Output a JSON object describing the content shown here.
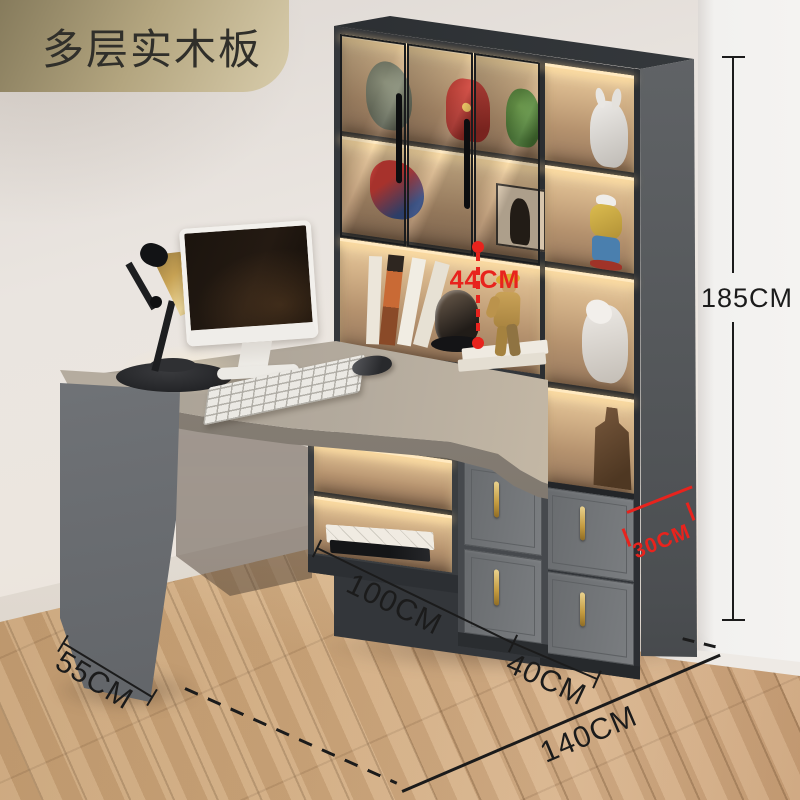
{
  "badge": {
    "label": "多层实木板"
  },
  "dimensions": {
    "shelf_clearance": {
      "label": "44CM"
    },
    "total_height": {
      "label": "185CM"
    },
    "cabinet_side_depth": {
      "label": "30CM"
    },
    "desk_length": {
      "label": "100CM"
    },
    "cabinet_front_width": {
      "label": "40CM"
    },
    "total_width": {
      "label": "140CM"
    },
    "desk_depth": {
      "label": "55CM"
    }
  },
  "palette": {
    "annotation_red": "#e8231d",
    "annotation_black": "#1b1b1b",
    "badge_gold_dark": "#8f8466",
    "badge_gold_light": "#d8ccab",
    "cabinet_charcoal": "#3f4246",
    "shelf_interior_tan": "#c8a27c",
    "led_glow": "#ffe9c0",
    "desk_gray": "#b3aa9d",
    "floor_wood": "#cda77c",
    "wall_beige": "#eae5e0",
    "handle_gold": "#c39a3f"
  }
}
